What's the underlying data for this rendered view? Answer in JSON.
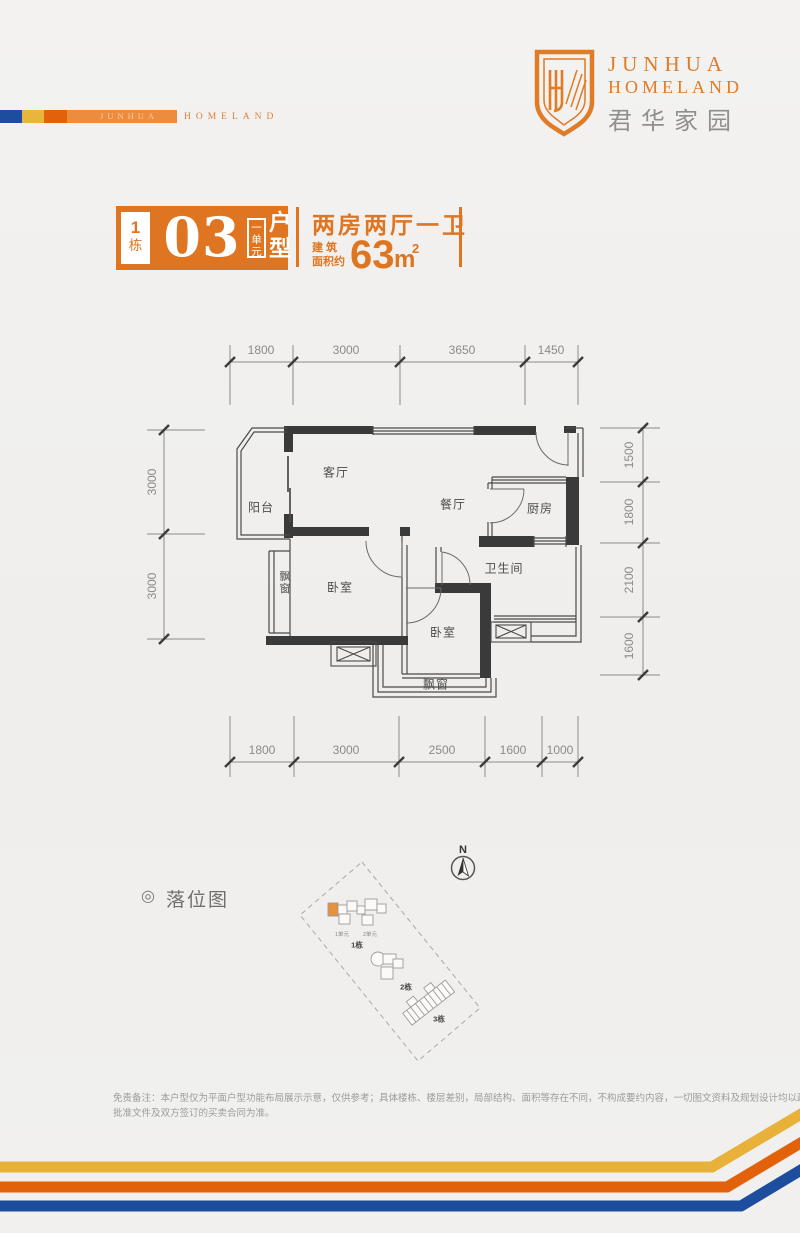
{
  "brand": {
    "logo_line1": "JUNHUA",
    "logo_line2": "HOMELAND",
    "logo_cn": "君华家园",
    "ribbon_watermark": "JUNHUA",
    "ribbon_text": "HOMELAND"
  },
  "colors": {
    "orange": "#df7520",
    "deep_orange": "#e2620b",
    "gold": "#e7b13a",
    "blue": "#1c4e9d",
    "light_orange": "#ec8c3e"
  },
  "title_block": {
    "building_no": "1",
    "building_suffix": "栋",
    "number": "03",
    "unit_tag": "一单元",
    "type_tag": "户型",
    "layout_desc": "两房两厅一卫",
    "area_label_1": "建 筑",
    "area_label_2": "面积约",
    "area_number": "63",
    "area_unit": "m",
    "area_exp": "2"
  },
  "floor_plan": {
    "dims_top": [
      "1800",
      "3000",
      "3650",
      "1450"
    ],
    "dims_bottom": [
      "1800",
      "3000",
      "2500",
      "1600",
      "1000"
    ],
    "dims_left": [
      "3000",
      "3000"
    ],
    "dims_right": [
      "1500",
      "1800",
      "2100",
      "1600"
    ],
    "rooms": {
      "balcony": "阳台",
      "living": "客厅",
      "dining": "餐厅",
      "kitchen": "厨房",
      "bay_left": "飘窗",
      "bedroom1": "卧室",
      "bath": "卫生间",
      "bedroom2": "卧室",
      "bay_bottom": "飘窗"
    }
  },
  "site_map": {
    "bullet": "◎",
    "label": "落位图",
    "compass": "N",
    "unit1": "1单元",
    "unit2": "2单元",
    "b1": "1栋",
    "b2": "2栋",
    "b3": "3栋"
  },
  "disclaimer": {
    "line1": "免责备注：本户型仅为平面户型功能布局展示示意，仅供参考；具体楼栋、楼层差别，局部结构、面积等存在不同，不构成要约内容，一切图文资料及规划设计均以政府最终",
    "line2": "批准文件及双方签订的买卖合同为准。"
  }
}
